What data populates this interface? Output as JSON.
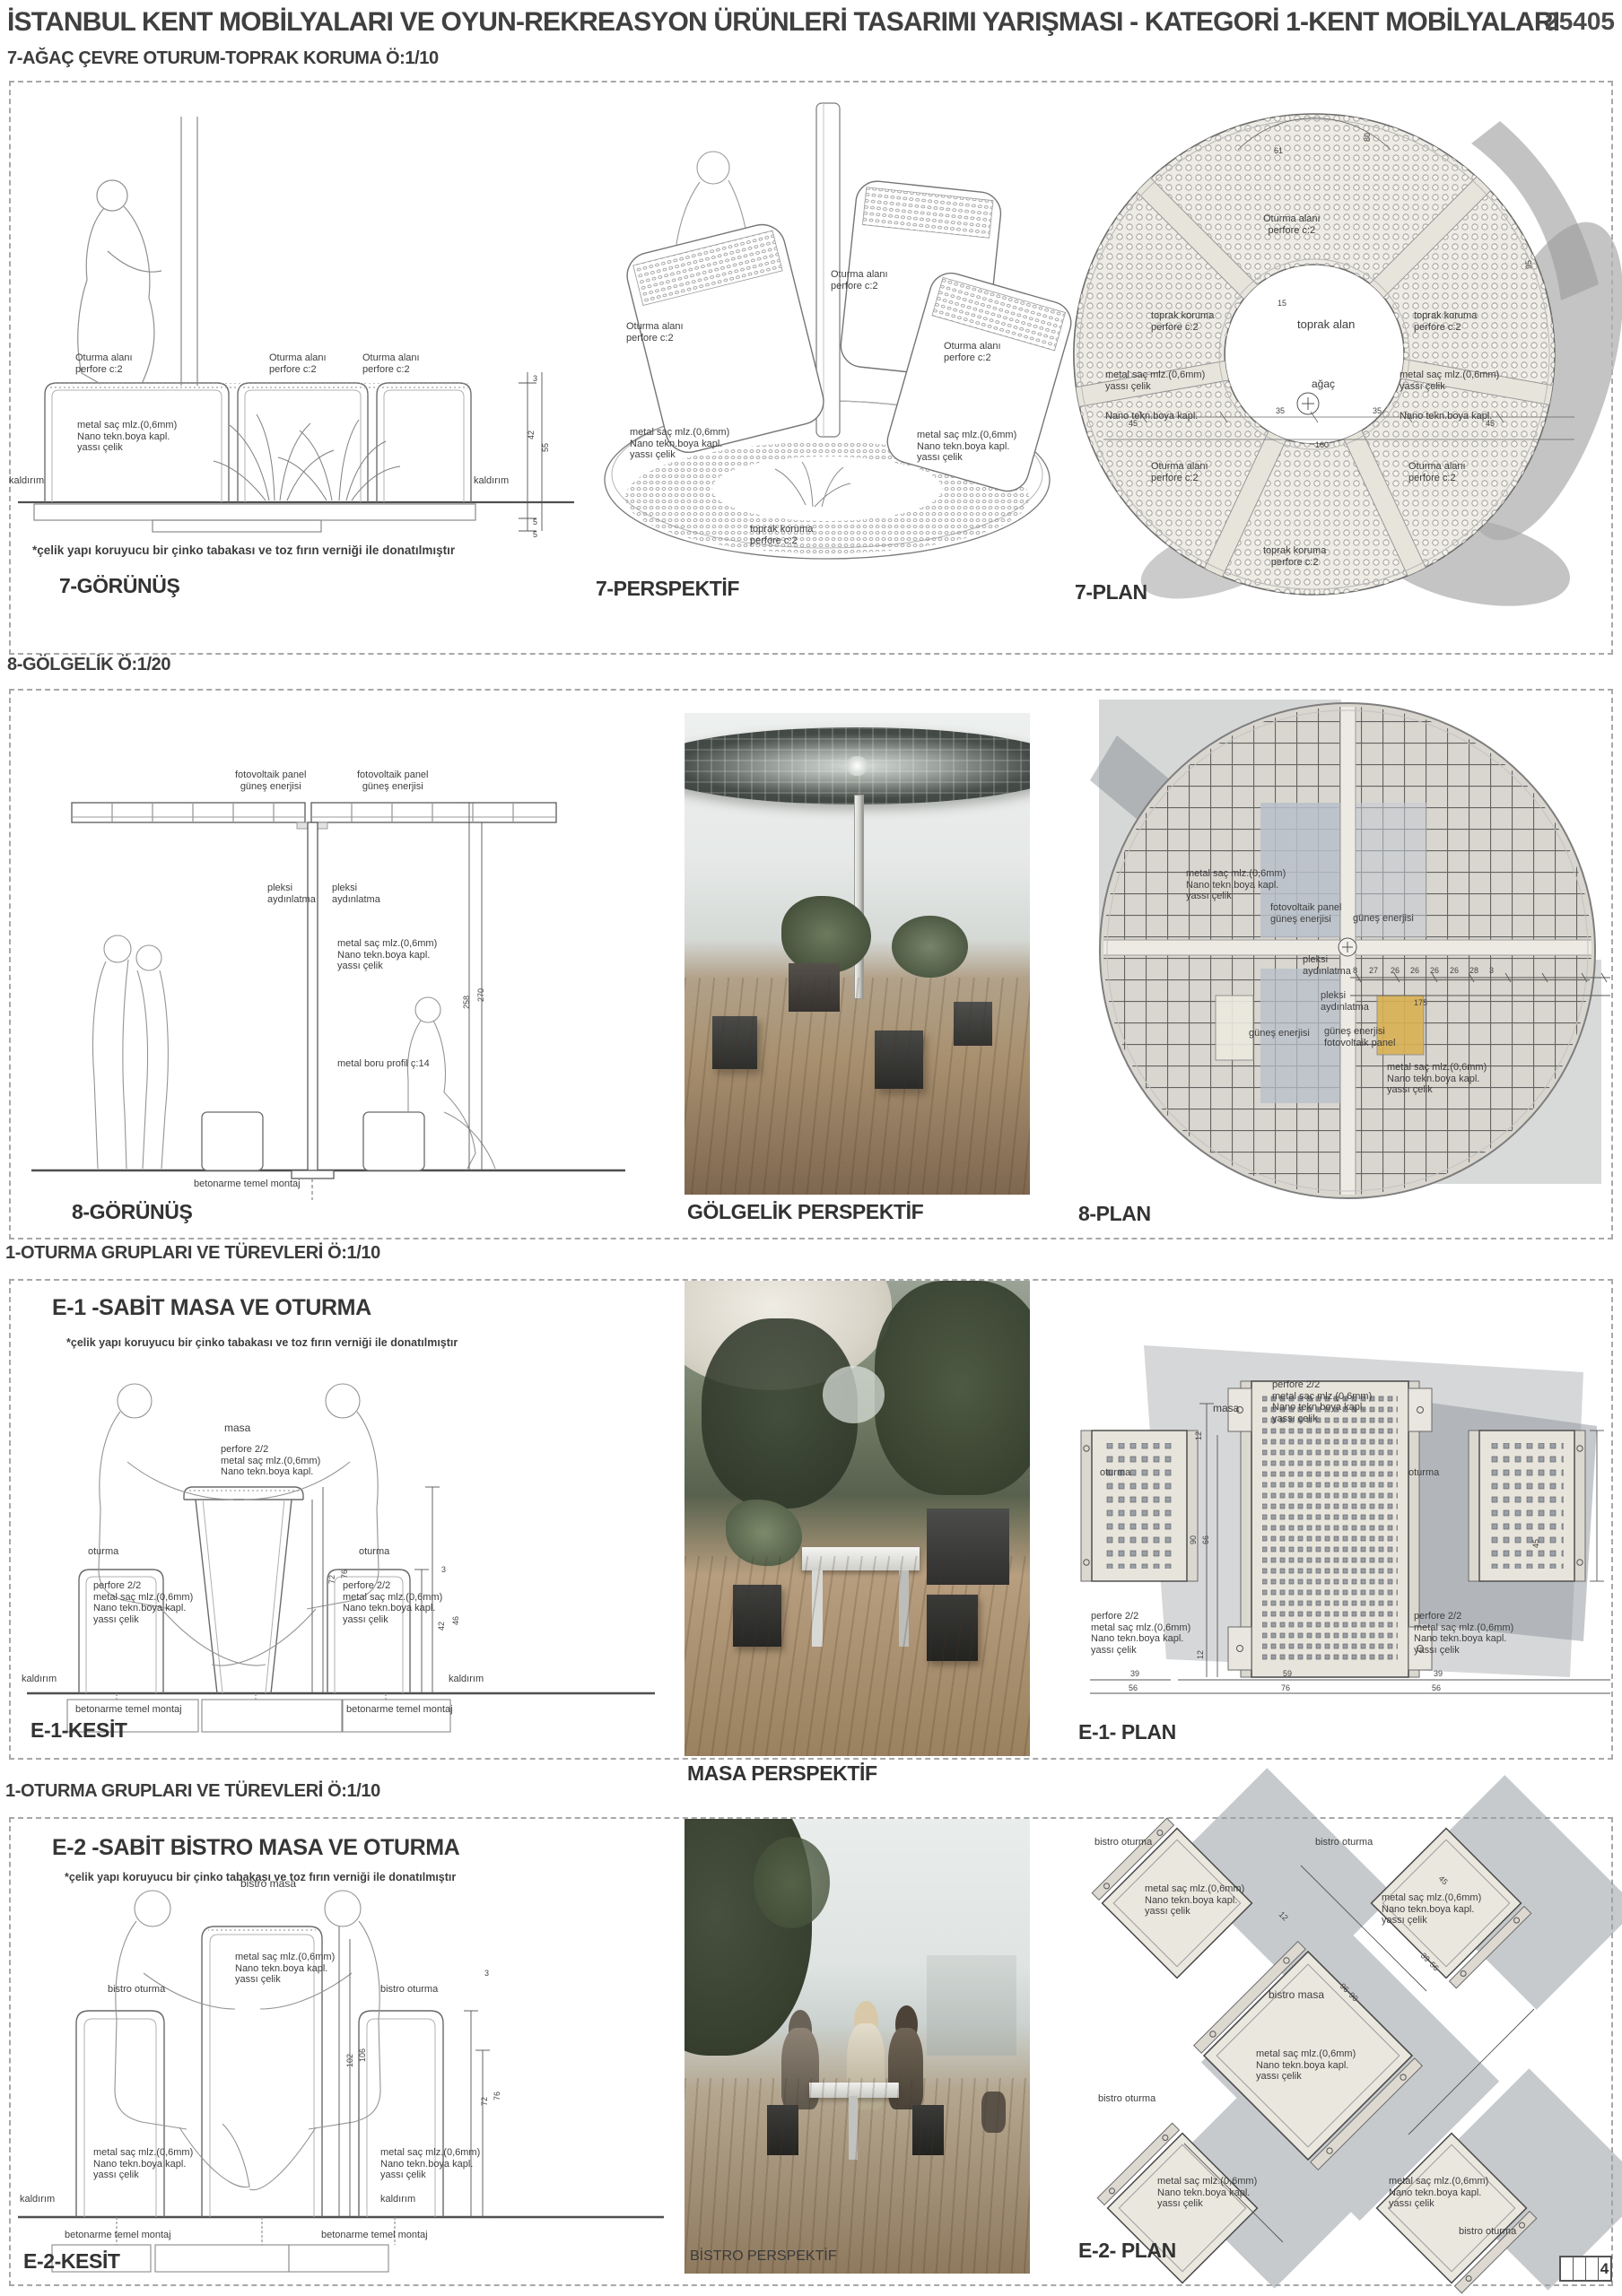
{
  "header": {
    "title": "İSTANBUL KENT MOBİLYALARI VE OYUN-REKREASYON ÜRÜNLERİ TASARIMI YARIŞMASI - KATEGORİ 1-KENT MOBİLYALARI",
    "entry_no": "25405"
  },
  "labels": {
    "oturma_alani": "Oturma alanı",
    "perfore_c2": "perfore c:2",
    "metal_sac": "metal saç mlz.(0,6mm)",
    "nano_boya": "Nano tekn.boya kapl.",
    "yassi_celik": "yassı çelik",
    "toprak_koruma": "toprak koruma",
    "toprak_alan": "toprak alan",
    "agac": "ağaç",
    "kaldirim": "kaldırım",
    "celik_note": "*çelik yapı koruyucu bir çinko tabakası ve toz fırın verniği ile donatılmıştır",
    "fotovoltaik_panel": "fotovoltaik panel",
    "gunes_enerjisi": "güneş enerjisi",
    "pleksi": "pleksi",
    "aydinlatma": "aydınlatma",
    "metal_boru": "metal boru profil ç:14",
    "betonarme": "betonarme temel montaj",
    "perfore_22": "perfore 2/2",
    "masa": "masa",
    "oturma": "oturma",
    "bistro_masa": "bistro masa",
    "bistro_oturma": "bistro oturma"
  },
  "section7": {
    "title": "7-AĞAÇ ÇEVRE OTURUM-TOPRAK KORUMA Ö:1/10",
    "caption_view": "7-GÖRÜNÜŞ",
    "caption_persp": "7-PERSPEKTİF",
    "caption_plan": "7-PLAN",
    "dims_view": [
      "3",
      "42",
      "55",
      "5",
      "5"
    ],
    "dims_plan": [
      "61",
      "80",
      "15",
      "35",
      "35",
      "160",
      "45",
      "45",
      "95"
    ]
  },
  "section8": {
    "title": "8-GÖLGELİK Ö:1/20",
    "caption_view": "8-GÖRÜNÜŞ",
    "caption_persp": "GÖLGELİK PERSPEKTİF",
    "caption_plan": "8-PLAN",
    "dims_view": [
      "258",
      "270"
    ],
    "dims_plan": [
      "8",
      "27",
      "26",
      "26",
      "26",
      "26",
      "28",
      "3",
      "175"
    ]
  },
  "sectionE1": {
    "group_title": "1-OTURMA GRUPLARI VE TÜREVLERİ Ö:1/10",
    "title": "E-1 -SABİT MASA VE OTURMA",
    "caption_kesit": "E-1-KESİT",
    "caption_persp": "MASA PERSPEKTİF",
    "caption_plan": "E-1- PLAN",
    "dims_kesit": [
      "72",
      "76",
      "3",
      "42",
      "46"
    ],
    "dims_plan_v": [
      "12",
      "90",
      "66",
      "45",
      "12"
    ],
    "dims_plan_row1": [
      "39",
      "59",
      "39"
    ],
    "dims_plan_row2": [
      "56",
      "76",
      "56"
    ]
  },
  "sectionE2": {
    "group_title": "1-OTURMA GRUPLARI VE TÜREVLERİ Ö:1/10",
    "title": "E-2 -SABİT BİSTRO MASA VE OTURMA",
    "caption_kesit": "E-2-KESİT",
    "caption_persp": "BİSTRO PERSPEKTİF",
    "caption_plan": "E-2- PLAN",
    "dims_kesit": [
      "102",
      "106",
      "3",
      "72",
      "76"
    ],
    "dims_plan": [
      "45",
      "96",
      "90",
      "39",
      "56",
      "12"
    ]
  },
  "page_strip": {
    "page": "4"
  },
  "colors": {
    "line": "#4a4a4a",
    "dash_border": "#a8a8a8",
    "plan_fill": "#e9e7e0",
    "shadow_gray": "#b5b5b5",
    "wood": "#a98f72"
  }
}
